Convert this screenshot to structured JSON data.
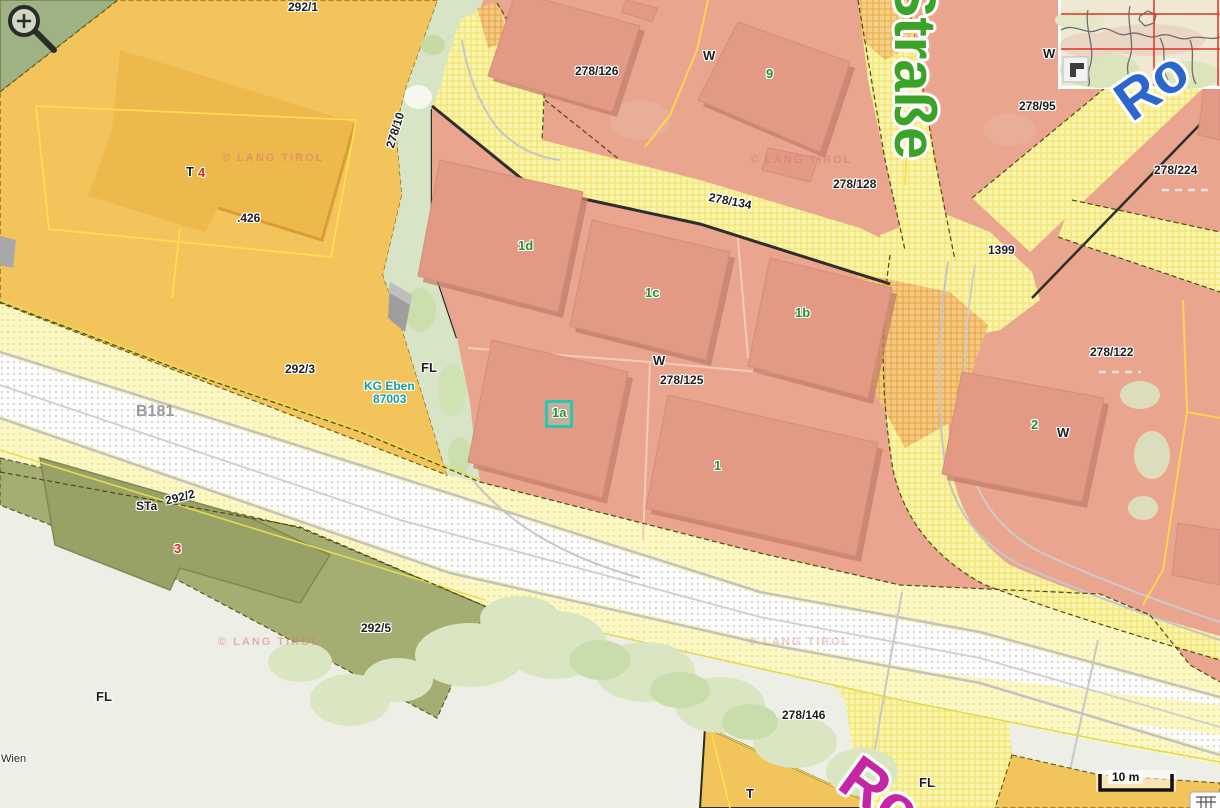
{
  "map_type": "cadastral parcel map viewer",
  "labels": {
    "parcels": {
      "p292_1": "292/1",
      "p292_3": "292/3",
      "p292_2": "292/2",
      "p292_5": "292/5",
      "p278_10": "278/10",
      "p278_126": "278/126",
      "p278_128": "278/128",
      "p278_134": "278/134",
      "p278_125": "278/125",
      "p278_95": "278/95",
      "p278_224": "278/224",
      "p278_122": "278/122",
      "p278_146": "278/146",
      "p1399": "1399",
      "p426": ".426"
    },
    "house_numbers": {
      "h9": "9",
      "h1d": "1d",
      "h1c": "1c",
      "h1b": "1b",
      "h1a": "1a",
      "h1": "1",
      "h2": "2",
      "h3": "3",
      "h4": "4"
    },
    "letters": {
      "w1": "W",
      "w2": "W",
      "w3": "W",
      "w4": "W",
      "fl1": "FL",
      "fl2": "FL",
      "fl3": "FL",
      "t1": "T",
      "t2": "T",
      "sta": "STa",
      "b181": "B181",
      "wien": "Wien"
    },
    "kg": {
      "line1": "KG Eben",
      "line2": "87003"
    },
    "copyright": "© LANG TIROL"
  },
  "streets": {
    "green": "r Straße",
    "blue": "Ro",
    "magenta": "Ro"
  },
  "controls": {
    "scale_bar": "10 m"
  },
  "colors": {
    "parcel_salmon": "#EAA58F",
    "building_salmon": "#E29A85",
    "parcel_orange": "#F3C35C",
    "building_orange": "#EDB84C",
    "parcel_olive": "#A4AD72",
    "building_olive": "#99A266",
    "road_yellow": "#FBF6B8",
    "road_orange_hatch": "#F6C983",
    "rail_white": "#FDFDFD",
    "green_area": "#9FB284",
    "strip_green": "#D8E4C6",
    "background": "#EDEFE6",
    "label_green": "#2E8F2E",
    "label_red": "#D42B1E",
    "label_teal": "#14A096",
    "street_green": "#3BA428",
    "street_blue": "#2B66CC",
    "street_magenta": "#C426A4",
    "selection_cyan": "#2EC4B0",
    "crosshair_red": "#E03226"
  }
}
